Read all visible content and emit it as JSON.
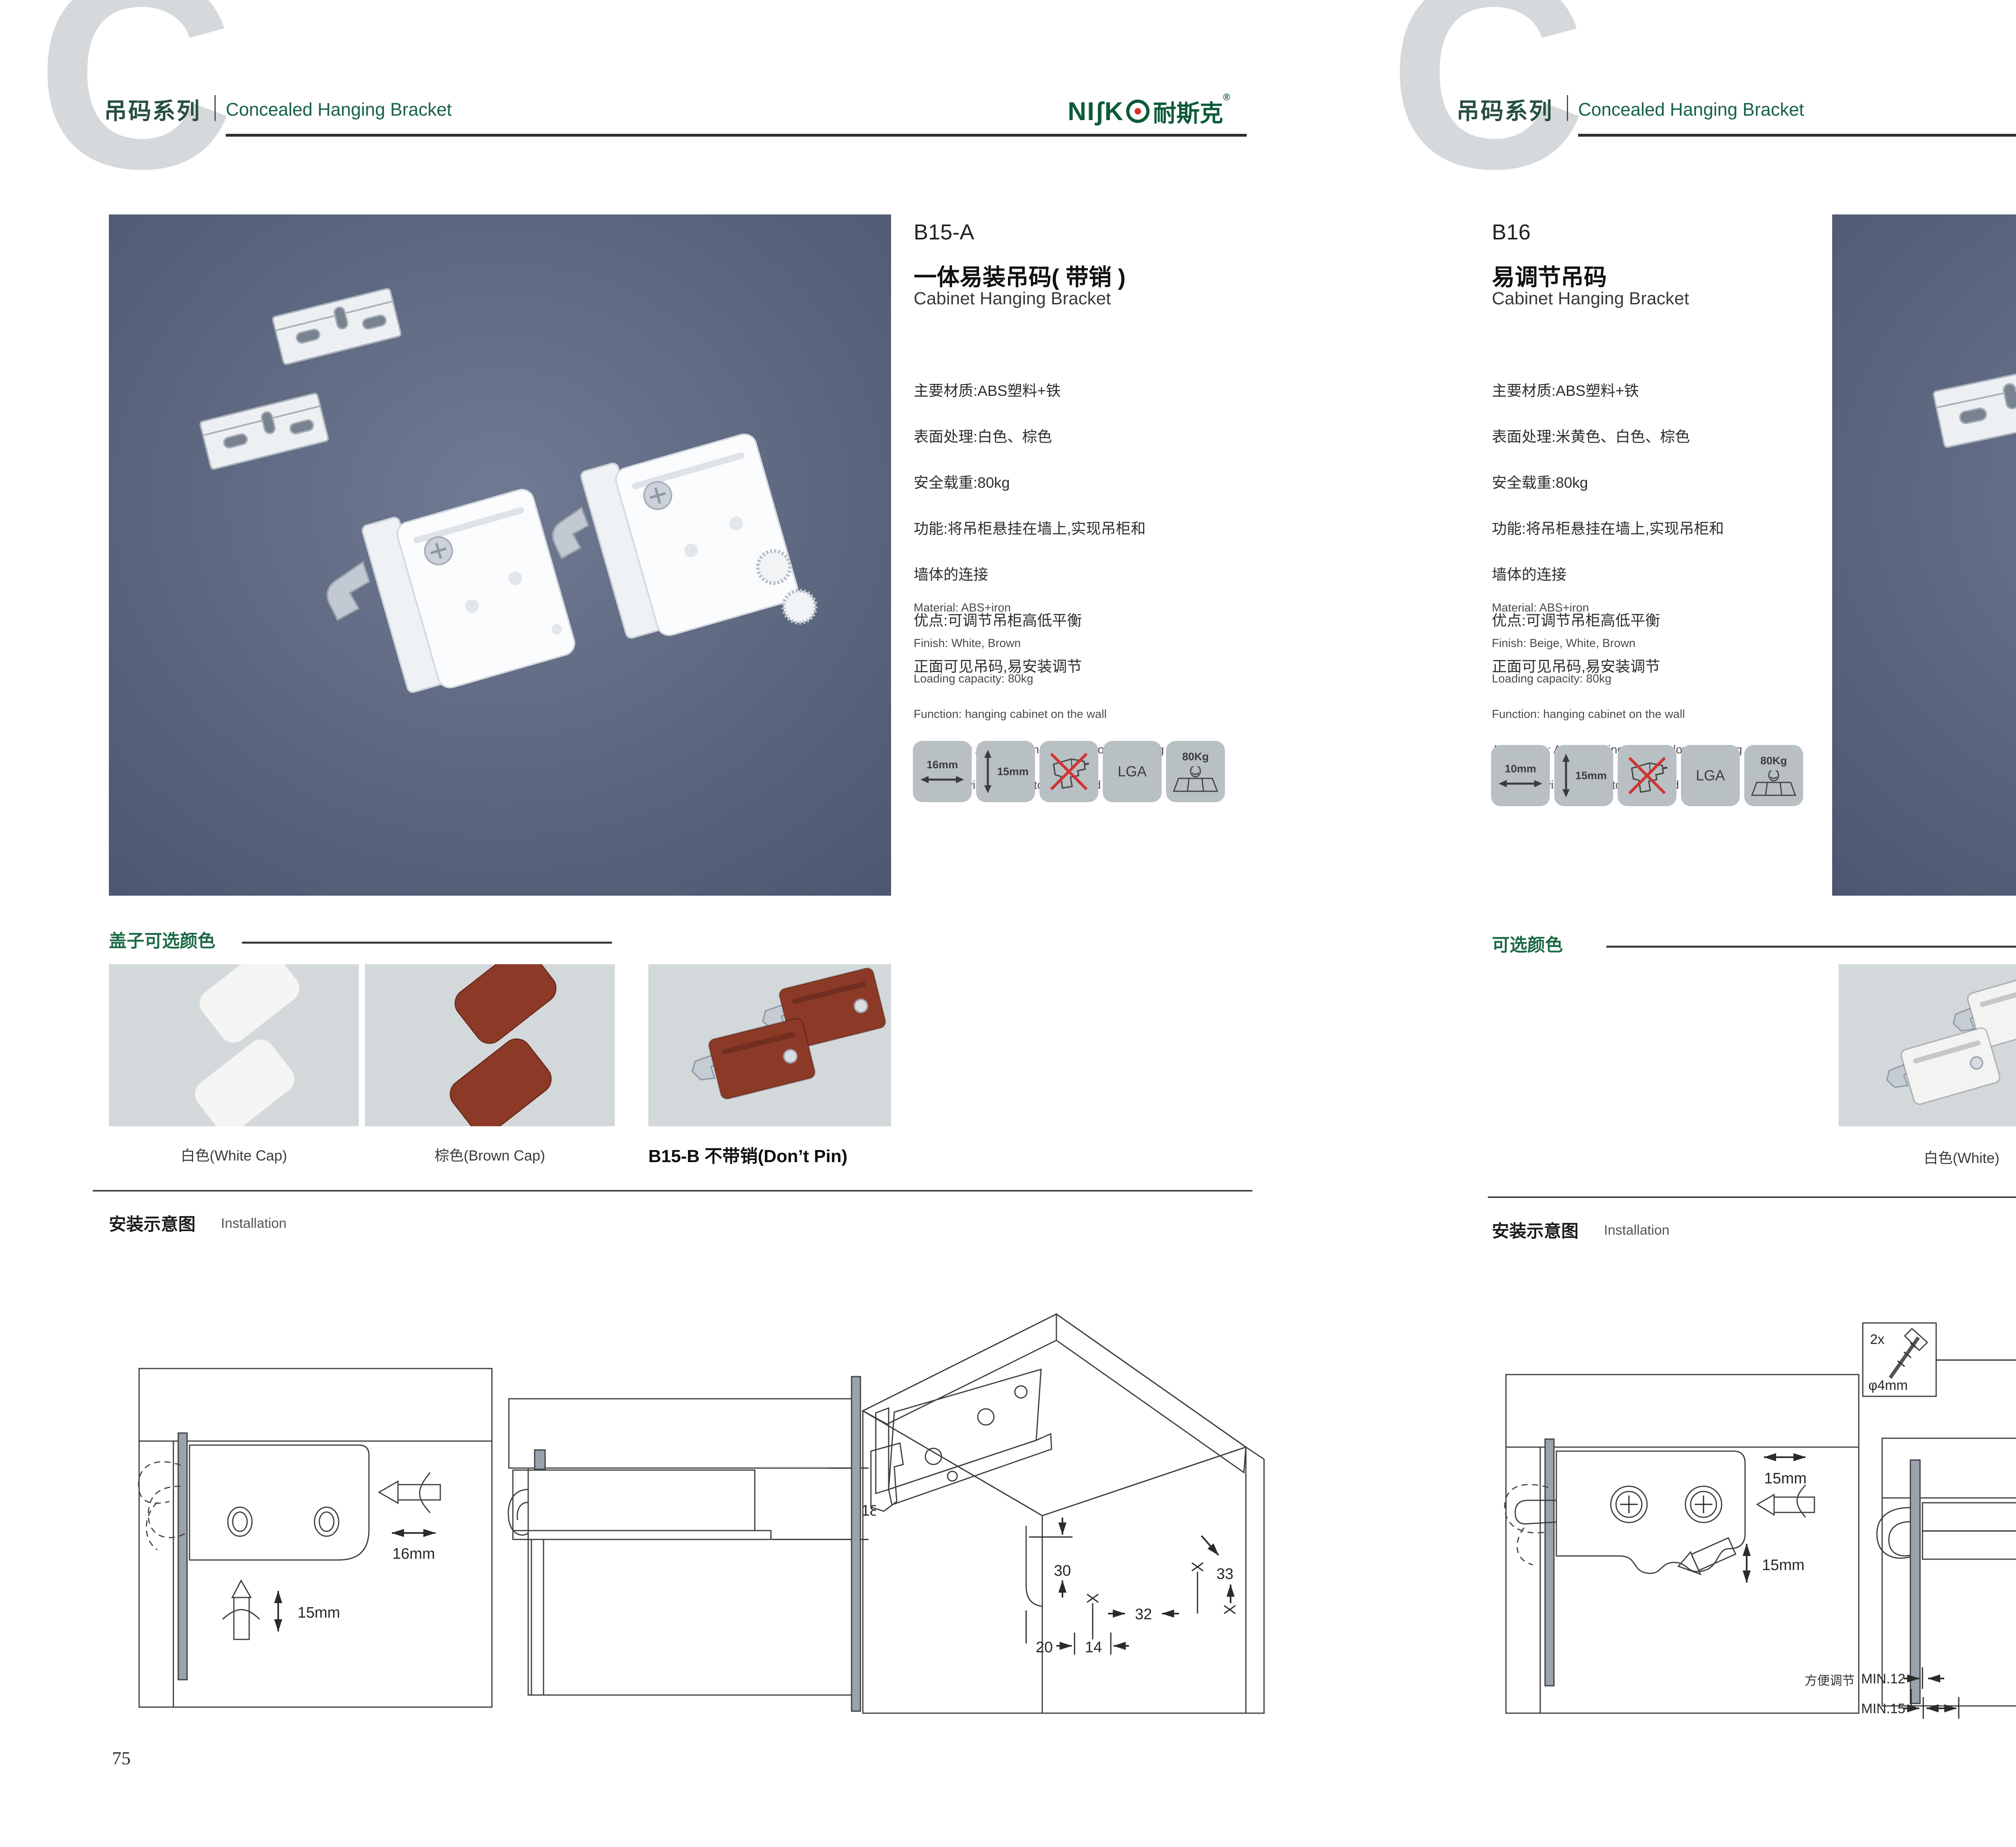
{
  "palette": {
    "brand_green": "#176247",
    "logo_green": "#0c5b38",
    "logo_red": "#d4322c",
    "photo_bg": "#59637b",
    "tile_bg": "#b9c0c4",
    "swatch_bg": "#d3d8db",
    "wood_yellow": "#f9dc85",
    "panel_beige": "#f7edd0",
    "part_gray": "#ccd3da"
  },
  "header": {
    "watermark": "C",
    "series_cn": "吊码系列",
    "series_en": "Concealed Hanging Bracket",
    "logo_text": "NIʃK",
    "logo_cn": "耐斯克",
    "logo_reg": "®"
  },
  "pages": [
    {
      "page_number": "75",
      "product": {
        "model": "B15-A",
        "name_cn": "一体易装吊码( 带销 )",
        "name_en": "Cabinet Hanging Bracket",
        "specs_cn": [
          "主要材质:ABS塑料+铁",
          "表面处理:白色、棕色",
          "安全载重:80kg",
          "功能:将吊柜悬挂在墙上,实现吊柜和",
          "墙体的连接",
          "优点:可调节吊柜高低平衡",
          "正面可见吊码,易安装调节"
        ],
        "specs_en": [
          "Material: ABS+iron",
          "Finish: White, Brown",
          "Loading capacity: 80kg",
          "Function: hanging cabinet on the wall",
          "Advantage: Adjust cabinet up and down hanging",
          "bracket is visible, easy to adjust and installed"
        ],
        "icons": {
          "width": "16mm",
          "height": "15mm",
          "cert": "LGA",
          "load": "80Kg"
        }
      },
      "colors_section": {
        "title": "盖子可选颜色",
        "options": [
          {
            "label": "白色(White Cap)",
            "hex": "#f5f5f3"
          },
          {
            "label": "棕色(Brown Cap)",
            "hex": "#8c3a27"
          },
          {
            "label": "B15-B 不带销(Don’t Pin)",
            "hex": "#8c3a27"
          }
        ]
      },
      "installation": {
        "title_cn": "安装示意图",
        "title_en": "Installation",
        "d1": {
          "h": "16mm",
          "v": "15mm"
        },
        "d2": {
          "depth": "18"
        },
        "d3": {
          "a": "33",
          "b": "30",
          "c": "32",
          "d": "20",
          "e": "14"
        }
      }
    },
    {
      "page_number": "76",
      "product": {
        "model": "B16",
        "name_cn": "易调节吊码",
        "name_en": "Cabinet Hanging Bracket",
        "specs_cn": [
          "主要材质:ABS塑料+铁",
          "表面处理:米黄色、白色、棕色",
          "安全载重:80kg",
          "功能:将吊柜悬挂在墙上,实现吊柜和",
          "墙体的连接",
          "优点:可调节吊柜高低平衡",
          "正面可见吊码,易安装调节"
        ],
        "specs_en": [
          "Material: ABS+iron",
          "Finish: Beige, White, Brown",
          "Loading capacity: 80kg",
          "Function: hanging cabinet on the wall",
          "Advantage: Adjust cabinet up and down hanging",
          "bracket is visible, easy to adjust and installed"
        ],
        "icons": {
          "width": "10mm",
          "height": "15mm",
          "cert": "LGA",
          "load": "80Kg"
        }
      },
      "colors_section": {
        "title": "可选颜色",
        "options": [
          {
            "label": "白色(White)",
            "hex": "#f3f3f1"
          },
          {
            "label": "棕色(Brown )",
            "hex": "#96352a"
          },
          {
            "label": "米黄色 (Beige)",
            "hex": "#e9d49c"
          }
        ]
      },
      "installation": {
        "title_cn": "安装示意图",
        "title_en": "Installation",
        "d1": {
          "h": "15mm",
          "v": "15mm",
          "note": "方便调节"
        },
        "d2": {
          "qty": "2x",
          "dia": "φ4mm",
          "depth": "19",
          "min1": "MIN.12",
          "min2": "MIN.15"
        },
        "d3": {
          "a": "30",
          "b": "32",
          "c": "RMAX4",
          "d": "19",
          "e": "20",
          "f": "32"
        }
      }
    }
  ]
}
